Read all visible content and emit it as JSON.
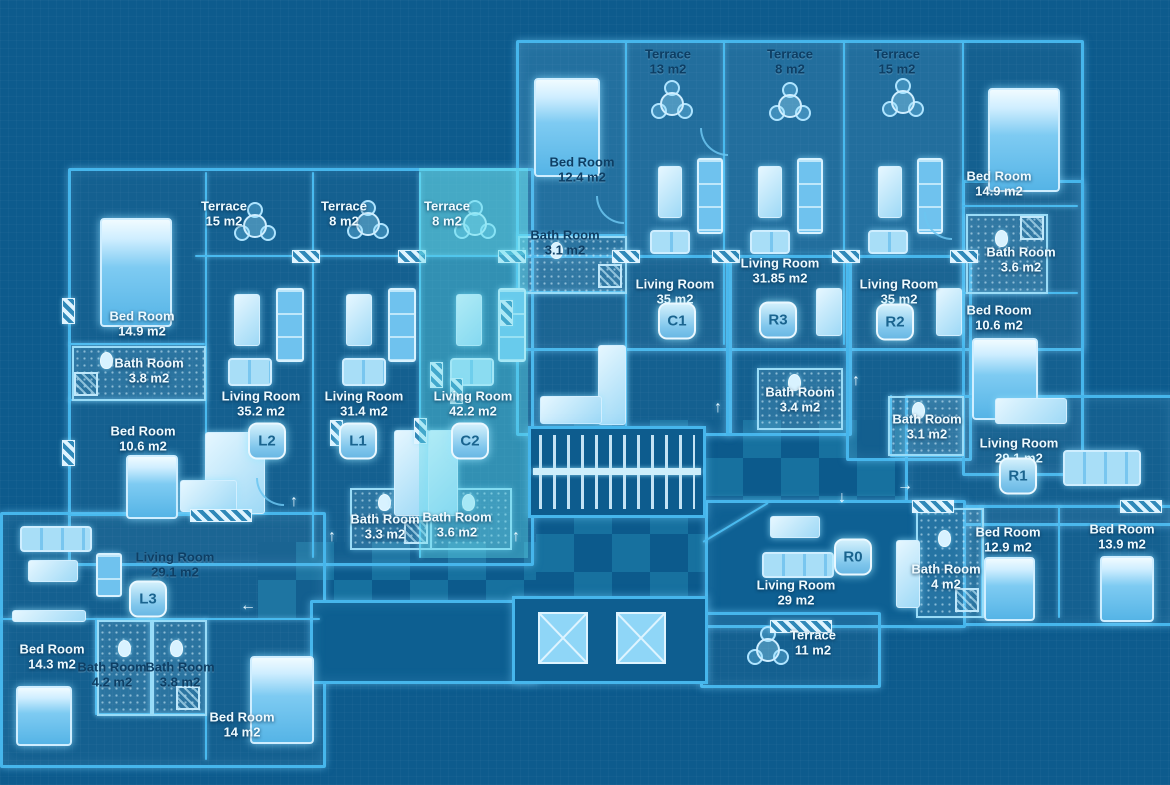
{
  "palette": {
    "background": "#0d5b8d",
    "wall": "#46b6ec",
    "wall_bright": "#dff4ff",
    "highlight_unit": "#60d9e8",
    "checker_light": "#17719f",
    "checker_dark": "#0c5a8c",
    "text_light": "#eefaff",
    "text_dark": "#0d3e64",
    "badge_fill": "#9fd9f5",
    "badge_text": "#1a648f"
  },
  "highlighted_unit": "C2",
  "units": [
    {
      "id": "L1"
    },
    {
      "id": "L2"
    },
    {
      "id": "L3"
    },
    {
      "id": "C1"
    },
    {
      "id": "C2"
    },
    {
      "id": "R0"
    },
    {
      "id": "R1"
    },
    {
      "id": "R2"
    },
    {
      "id": "R3"
    }
  ],
  "rooms": [
    {
      "name": "Terrace",
      "area": "15 m2"
    },
    {
      "name": "Terrace",
      "area": "8 m2"
    },
    {
      "name": "Terrace",
      "area": "8 m2"
    },
    {
      "name": "Terrace",
      "area": "13 m2"
    },
    {
      "name": "Terrace",
      "area": "8 m2"
    },
    {
      "name": "Terrace",
      "area": "15 m2"
    },
    {
      "name": "Terrace",
      "area": "11 m2"
    },
    {
      "name": "Bed Room",
      "area": "12.4 m2"
    },
    {
      "name": "Bed Room",
      "area": "14.9 m2"
    },
    {
      "name": "Bath Room",
      "area": "3.8 m2"
    },
    {
      "name": "Bed Room",
      "area": "10.6 m2"
    },
    {
      "name": "Living Room",
      "area": "35.2 m2"
    },
    {
      "name": "Living Room",
      "area": "31.4 m2"
    },
    {
      "name": "Living Room",
      "area": "42.2 m2"
    },
    {
      "name": "Bed Room",
      "area": "14.9 m2"
    },
    {
      "name": "Bath Room",
      "area": "3.6 m2"
    },
    {
      "name": "Bed Room",
      "area": "10.6 m2"
    },
    {
      "name": "Living Room",
      "area": "35 m2"
    },
    {
      "name": "Living Room",
      "area": "31.85 m2"
    },
    {
      "name": "Living Room",
      "area": "35 m2"
    },
    {
      "name": "Bath Room",
      "area": "3.4 m2"
    },
    {
      "name": "Bath Room",
      "area": "3.1 m2"
    },
    {
      "name": "Living Room",
      "area": "29.1 m2"
    },
    {
      "name": "Bath Room",
      "area": "3.3 m2"
    },
    {
      "name": "Bath Room",
      "area": "3.6 m2"
    },
    {
      "name": "Living Room",
      "area": "29.1 m2"
    },
    {
      "name": "Living Room",
      "area": "29 m2"
    },
    {
      "name": "Bath Room",
      "area": "4 m2"
    },
    {
      "name": "Bed Room",
      "area": "12.9 m2"
    },
    {
      "name": "Bed Room",
      "area": "13.9 m2"
    },
    {
      "name": "Bed Room",
      "area": "14.3 m2"
    },
    {
      "name": "Bath Room",
      "area": "4.2 m2"
    },
    {
      "name": "Bath Room",
      "area": "3.8 m2"
    },
    {
      "name": "Bed Room",
      "area": "14 m2"
    },
    {
      "name": "Bath Room",
      "area": "3.1 m2"
    }
  ]
}
